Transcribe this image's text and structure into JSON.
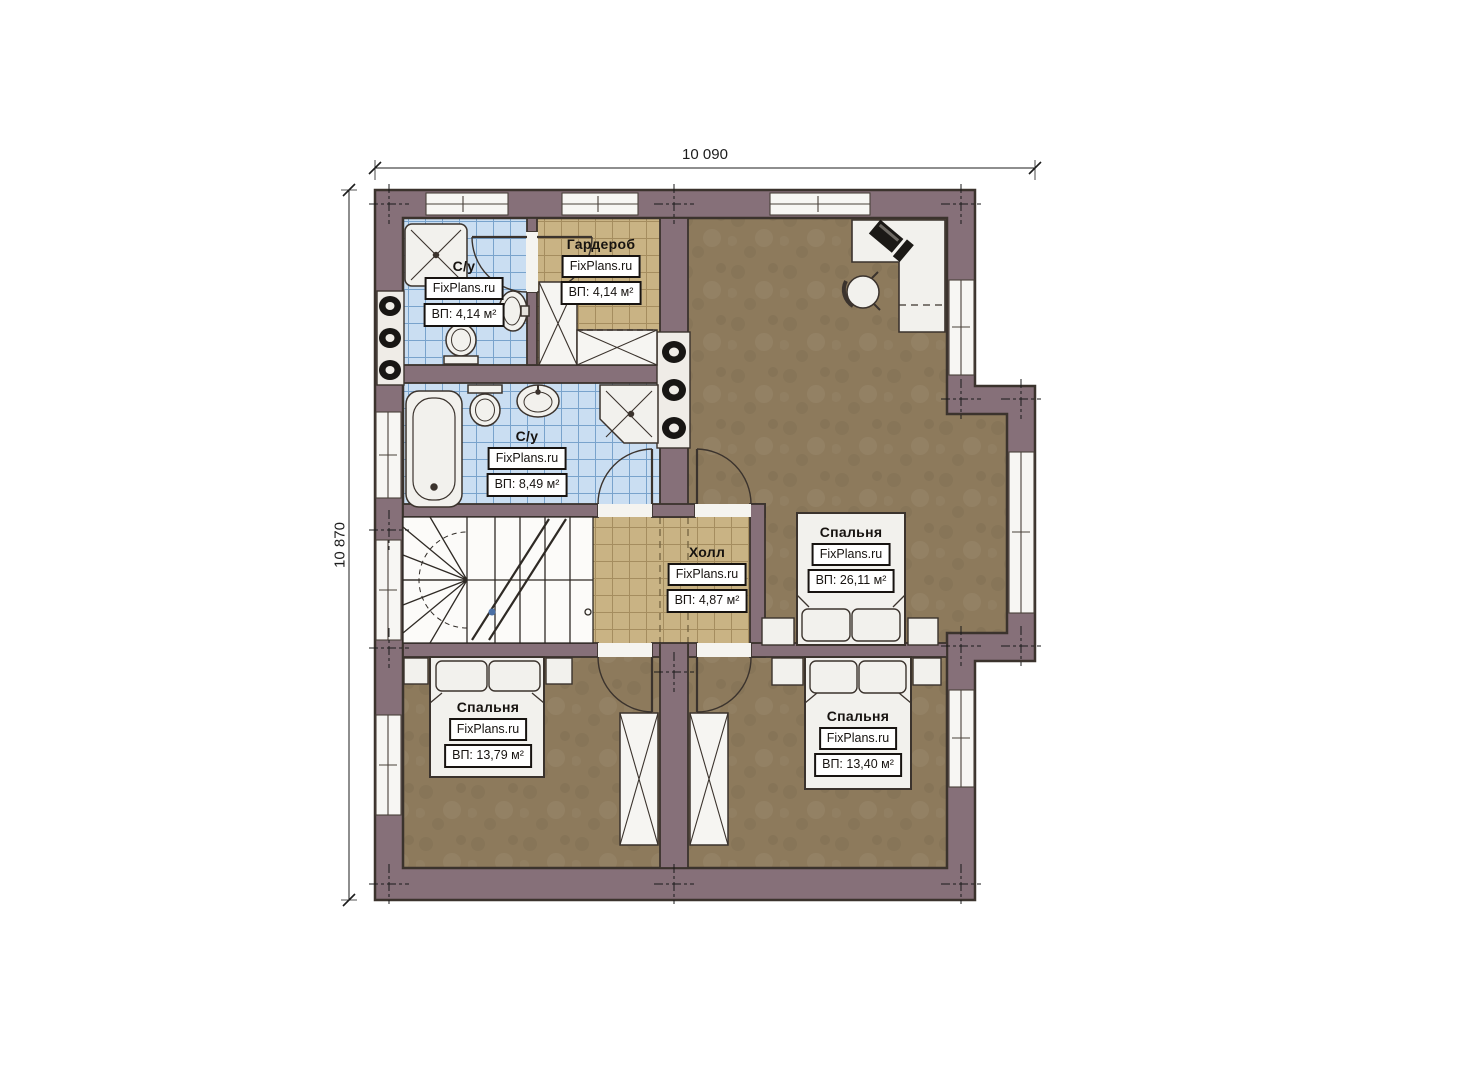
{
  "plan": {
    "type": "floor-plan",
    "brand_watermark": "FixPlans.ru"
  },
  "dimensions": {
    "width_label": "10 090",
    "height_label": "10 870"
  },
  "rooms": [
    {
      "id": "bath-top",
      "name": "С/у",
      "brand": "FixPlans.ru",
      "area": "ВП: 4,14 м²"
    },
    {
      "id": "wardrobe",
      "name": "Гардероб",
      "brand": "FixPlans.ru",
      "area": "ВП: 4,14 м²"
    },
    {
      "id": "bath-main",
      "name": "С/у",
      "brand": "FixPlans.ru",
      "area": "ВП: 8,49 м²"
    },
    {
      "id": "hall",
      "name": "Холл",
      "brand": "FixPlans.ru",
      "area": "ВП: 4,87 м²"
    },
    {
      "id": "bedroom-master",
      "name": "Спальня",
      "brand": "FixPlans.ru",
      "area": "ВП: 26,11 м²"
    },
    {
      "id": "bedroom-left",
      "name": "Спальня",
      "brand": "FixPlans.ru",
      "area": "ВП: 13,79 м²"
    },
    {
      "id": "bedroom-right",
      "name": "Спальня",
      "brand": "FixPlans.ru",
      "area": "ВП: 13,40 м²"
    }
  ],
  "colors": {
    "wall": "#867079",
    "wall_outline": "#3b332d",
    "floor_wood": "#8d7a5c",
    "tile_bath": "#cadef2",
    "tile_hall": "#c9b384",
    "fixture_white": "#f2f1ed"
  }
}
